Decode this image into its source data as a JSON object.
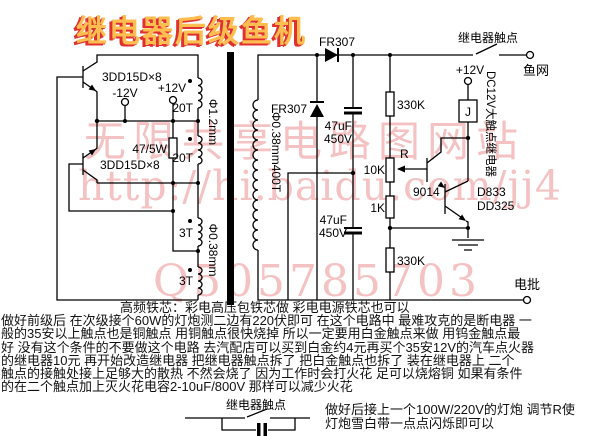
{
  "title": "继电器后级鱼机",
  "watermarks": {
    "line1": "无限共享电路图网站",
    "line2": "http://hi.baidu.com/jj4",
    "line3": "Q505785703"
  },
  "colors": {
    "background": "#ffffff",
    "wire": "#000000",
    "title_fill": "#ffbe4f",
    "title_shadow": "#e03030",
    "watermark_pink": "rgba(232,128,128,0.48)"
  },
  "schematic": {
    "labels": {
      "q1": "3DD15D×8",
      "q2": "3DD15D×8",
      "neg12": "-12V",
      "pos12": "+12V",
      "w20t_1": "20T",
      "w20t_2": "20T",
      "w3t_1": "3T",
      "w3t_2": "3T",
      "phi12": "Φ1.2mm",
      "phi038": "Φ0.38mm",
      "phi038_400t": "Φ0.38mm400T",
      "r_bias": "47/5W",
      "d1": "FR307",
      "d2": "FR307",
      "c1_a": "47uF",
      "c1_b": "450V",
      "c2_a": "47uF",
      "c2_b": "450V",
      "r1": "330K",
      "pot_name": "R",
      "pot": "10K",
      "r2": "1K",
      "r3": "330K",
      "q3": "9014",
      "q4a": "D833",
      "q4b": "DD325",
      "relay_pos12": "+12V",
      "relay_coil": "J",
      "relay_type": "DC12V大触点继电器",
      "contact_top": "继电器触点",
      "fishnet": "鱼网",
      "rod": "电批"
    }
  },
  "snubber": {
    "label": "继电器触点"
  },
  "notes": {
    "line1": "高频铁芯：彩电高压包铁芯做  彩电电源铁芯也可以",
    "line2": "做好前级后 在次级接个60W的灯炮测二边有220伏即可 在这个电路中 最难攻克的是断电器 一",
    "line3": "般的35安以上触点也是铜触点 用铜触点很快烧掉 所以一定要用白金触点来做 用钨金触点最",
    "line4": "好 没有这个条件的不要做这个电路 去汽配店可以买到白金约4元再买个35安12V的汽车点火器",
    "line5": "的继电器10元 再开始改造继电器 把继电器触点拆了 把白金触点也拆了 装在继电器上 二个",
    "line6": "触点的接触处接上足够大的散热 不然会烧了 因为工作时会打火花 足可以烧熔铜 如果有条件",
    "line7": "的在二个触点加上灭火花电容2-10uF/800V 那样可以减少火花",
    "tip_line1": "做好后接上一个100W/220V的灯炮 调节R使",
    "tip_line2": "灯炮雪白带一点点闪烁即可以"
  }
}
